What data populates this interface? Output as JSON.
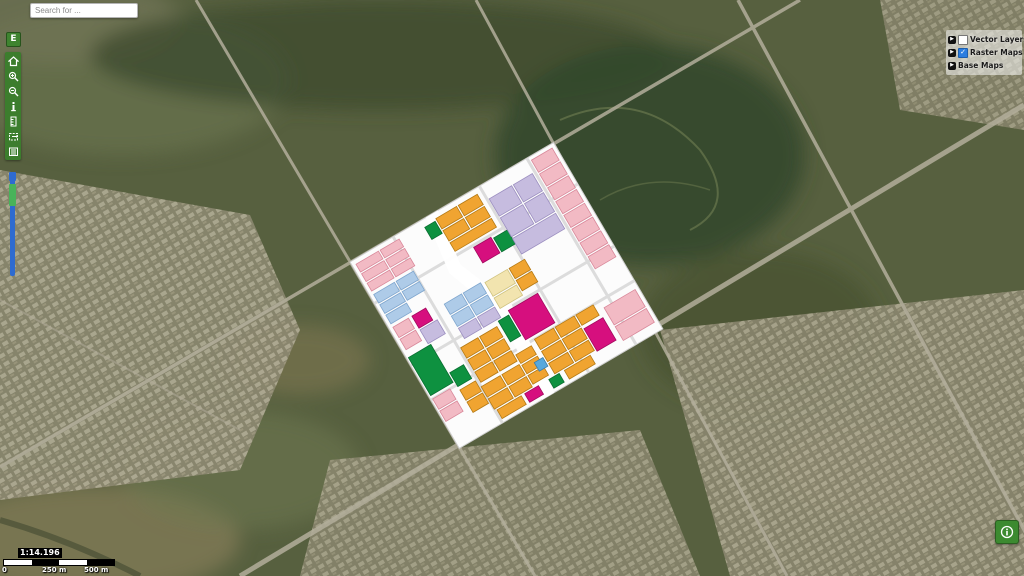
{
  "app": {
    "title": "Web GIS Map Viewer"
  },
  "search": {
    "placeholder": "Search for ..."
  },
  "expand_button": {
    "label": "E"
  },
  "toolbar": {
    "buttons": [
      "home",
      "zoom-in",
      "zoom-out",
      "info",
      "measure",
      "zoom-extent",
      "legend"
    ],
    "color": "#3c7d2d"
  },
  "zoom_slider": {
    "track_color": "#2e6bd0",
    "handle_color": "#49b35a"
  },
  "layer_panel": {
    "groups": [
      {
        "label": "Vector Layers",
        "has_checkbox": true,
        "checked": false
      },
      {
        "label": "Raster Maps",
        "has_checkbox": true,
        "checked": true
      },
      {
        "label": "Base Maps",
        "has_checkbox": false,
        "checked": false
      }
    ],
    "accent_color": "#2b7de0"
  },
  "icons": {
    "arrow": "▶",
    "check": "✓"
  },
  "scale": {
    "ratio_text": "1:14.196",
    "bar_labels": {
      "zero": "0",
      "mid": "250 m",
      "end": "500 m"
    }
  },
  "info_button": {
    "icon": "info"
  },
  "overlay_map": {
    "description": "rotated land-use raster overlay",
    "rotation_deg": -30.4,
    "origin": [
      350,
      262
    ],
    "sheet_size": [
      236,
      216
    ],
    "palette": {
      "o": {
        "f": "#F0A431",
        "s": "#B57A14"
      },
      "p": {
        "f": "#F2BAC4",
        "s": "#D9889A"
      },
      "m": {
        "f": "#D60F7E",
        "s": "#A30B5F"
      },
      "g": {
        "f": "#0E9140",
        "s": "#0A6E31"
      },
      "l": {
        "f": "#C6BCDF",
        "s": "#9C8FC0"
      },
      "b": {
        "f": "#AECBE8",
        "s": "#7FA6CE"
      },
      "c": {
        "f": "#F2E4AF",
        "s": "#CFC27F"
      },
      "s": {
        "f": "#57A8DC",
        "s": "#3C7EAA"
      }
    },
    "parcels": [
      [
        4,
        5,
        26,
        9,
        "p"
      ],
      [
        4,
        16,
        26,
        9,
        "p"
      ],
      [
        4,
        27,
        26,
        9,
        "p"
      ],
      [
        32,
        5,
        22,
        9,
        "p"
      ],
      [
        32,
        16,
        22,
        9,
        "p"
      ],
      [
        32,
        27,
        22,
        9,
        "p"
      ],
      [
        4,
        40,
        24,
        10,
        "b"
      ],
      [
        4,
        52,
        24,
        10,
        "b"
      ],
      [
        4,
        64,
        24,
        10,
        "b"
      ],
      [
        30,
        40,
        20,
        10,
        "b"
      ],
      [
        30,
        52,
        20,
        10,
        "b"
      ],
      [
        4,
        78,
        18,
        12,
        "p"
      ],
      [
        4,
        92,
        18,
        12,
        "p"
      ],
      [
        26,
        78,
        16,
        14,
        "m"
      ],
      [
        26,
        94,
        20,
        16,
        "l"
      ],
      [
        2,
        112,
        26,
        44,
        "g"
      ],
      [
        2,
        160,
        20,
        12,
        "p"
      ],
      [
        2,
        174,
        20,
        12,
        "p"
      ],
      [
        96,
        6,
        24,
        12,
        "o"
      ],
      [
        122,
        6,
        22,
        12,
        "o"
      ],
      [
        96,
        20,
        24,
        12,
        "o"
      ],
      [
        122,
        20,
        22,
        12,
        "o"
      ],
      [
        96,
        34,
        48,
        10,
        "o"
      ],
      [
        82,
        8,
        12,
        14,
        "g"
      ],
      [
        114,
        50,
        20,
        18,
        "m"
      ],
      [
        136,
        52,
        16,
        16,
        "g"
      ],
      [
        152,
        16,
        26,
        20,
        "l"
      ],
      [
        180,
        16,
        22,
        20,
        "l"
      ],
      [
        152,
        38,
        26,
        22,
        "l"
      ],
      [
        180,
        38,
        22,
        22,
        "l"
      ],
      [
        152,
        62,
        50,
        18,
        "l"
      ],
      [
        208,
        4,
        24,
        14,
        "p"
      ],
      [
        208,
        20,
        24,
        14,
        "p"
      ],
      [
        208,
        36,
        24,
        14,
        "p"
      ],
      [
        208,
        52,
        24,
        14,
        "p"
      ],
      [
        208,
        68,
        24,
        14,
        "p"
      ],
      [
        208,
        84,
        24,
        14,
        "p"
      ],
      [
        208,
        100,
        24,
        14,
        "p"
      ],
      [
        208,
        116,
        24,
        14,
        "p"
      ],
      [
        196,
        168,
        36,
        20,
        "p"
      ],
      [
        196,
        190,
        36,
        16,
        "p"
      ],
      [
        60,
        84,
        20,
        12,
        "b"
      ],
      [
        82,
        84,
        20,
        12,
        "b"
      ],
      [
        60,
        98,
        20,
        12,
        "b"
      ],
      [
        82,
        98,
        20,
        12,
        "b"
      ],
      [
        60,
        112,
        20,
        12,
        "l"
      ],
      [
        82,
        112,
        20,
        12,
        "l"
      ],
      [
        106,
        86,
        26,
        16,
        "c"
      ],
      [
        106,
        104,
        26,
        12,
        "c"
      ],
      [
        134,
        86,
        18,
        12,
        "o"
      ],
      [
        134,
        100,
        18,
        12,
        "o"
      ],
      [
        112,
        122,
        34,
        34,
        "m"
      ],
      [
        98,
        126,
        12,
        24,
        "g"
      ],
      [
        120,
        160,
        22,
        12,
        "o"
      ],
      [
        144,
        160,
        22,
        12,
        "o"
      ],
      [
        168,
        160,
        20,
        12,
        "o"
      ],
      [
        120,
        174,
        22,
        12,
        "o"
      ],
      [
        144,
        174,
        22,
        12,
        "o"
      ],
      [
        120,
        188,
        22,
        12,
        "o"
      ],
      [
        144,
        188,
        22,
        12,
        "o"
      ],
      [
        168,
        176,
        22,
        26,
        "m"
      ],
      [
        52,
        130,
        20,
        12,
        "o"
      ],
      [
        74,
        130,
        20,
        12,
        "o"
      ],
      [
        52,
        144,
        20,
        12,
        "o"
      ],
      [
        74,
        144,
        20,
        12,
        "o"
      ],
      [
        52,
        158,
        20,
        12,
        "o"
      ],
      [
        74,
        158,
        20,
        12,
        "o"
      ],
      [
        30,
        166,
        18,
        12,
        "o"
      ],
      [
        30,
        180,
        18,
        12,
        "o"
      ],
      [
        50,
        174,
        22,
        12,
        "o"
      ],
      [
        50,
        188,
        22,
        12,
        "o"
      ],
      [
        74,
        174,
        20,
        12,
        "o"
      ],
      [
        74,
        188,
        20,
        12,
        "o"
      ],
      [
        96,
        164,
        18,
        10,
        "o"
      ],
      [
        96,
        176,
        18,
        10,
        "o"
      ],
      [
        96,
        188,
        18,
        10,
        "o"
      ],
      [
        30,
        146,
        16,
        16,
        "g"
      ],
      [
        84,
        202,
        16,
        10,
        "m"
      ],
      [
        108,
        180,
        10,
        10,
        "s"
      ],
      [
        112,
        202,
        12,
        10,
        "g"
      ],
      [
        130,
        202,
        30,
        10,
        "o"
      ],
      [
        52,
        202,
        28,
        10,
        "o"
      ]
    ]
  }
}
